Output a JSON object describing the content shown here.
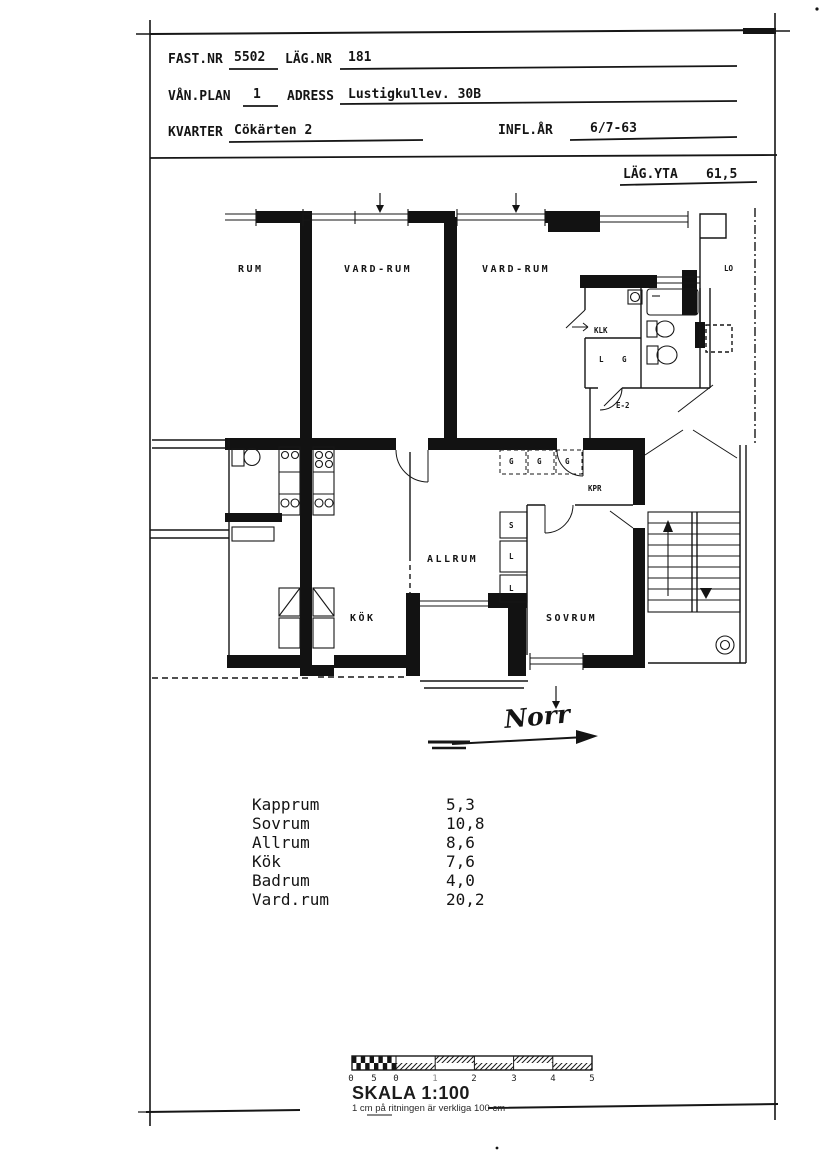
{
  "header": {
    "fast_nr_label": "FAST.NR",
    "fast_nr_value": "5502",
    "lag_nr_label": "LÄG.NR",
    "lag_nr_value": "181",
    "van_plan_label": "VÅN.PLAN",
    "van_plan_value": "1",
    "adress_label": "ADRESS",
    "adress_value": "Lustigkullev. 30B",
    "kvarter_label": "KVARTER",
    "kvarter_value": "Cökärten 2",
    "infl_ar_label": "INFL.ÅR",
    "infl_ar_value": "6/7-63",
    "lag_yta_label": "LÄG.YTA",
    "lag_yta_value": "61,5"
  },
  "plan": {
    "labels": {
      "rum": "RUM",
      "vard_rum_1": "VARD-RUM",
      "vard_rum_2": "VARD-RUM",
      "lo": "LO",
      "klk": "KLK",
      "closet_l": "L",
      "closet_g": "G",
      "e2": "E-2",
      "kpr": "KPR",
      "g": "G",
      "s": "S",
      "l": "L",
      "kok": "KÖK",
      "allrum": "ALLRUM",
      "sovrum": "SOVRUM"
    },
    "north_label": "Norr"
  },
  "room_table": {
    "rows": [
      {
        "name": "Kapprum",
        "area": "5,3"
      },
      {
        "name": "Sovrum",
        "area": "10,8"
      },
      {
        "name": "Allrum",
        "area": "8,6"
      },
      {
        "name": "Kök",
        "area": "7,6"
      },
      {
        "name": "Badrum",
        "area": "4,0"
      },
      {
        "name": "Vard.rum",
        "area": "20,2"
      }
    ]
  },
  "scale": {
    "skala_label": "SKALA 1:100",
    "note": "1 cm på ritningen är verkliga 100 cm",
    "tick_labels": [
      "0",
      "5",
      "0",
      "1",
      "2",
      "3",
      "4",
      "5"
    ]
  }
}
